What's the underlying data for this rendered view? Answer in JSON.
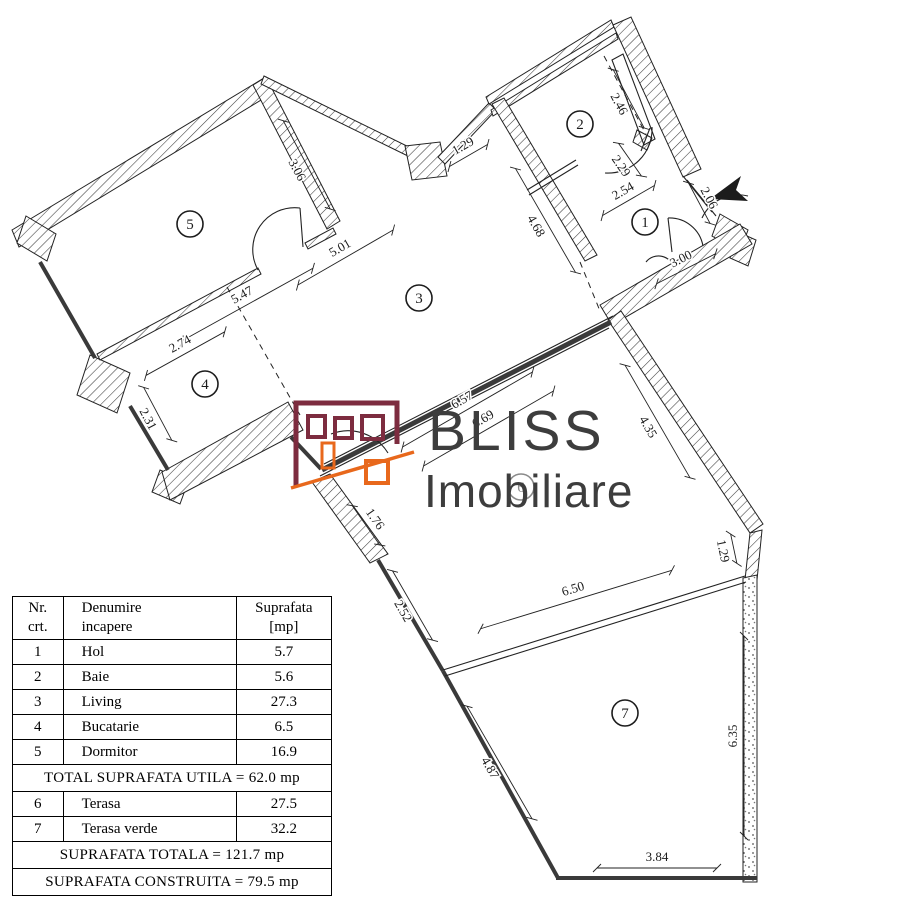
{
  "logo": {
    "line1": "BLISS",
    "line2": "Imobiliare",
    "house_color": "#7d2c3f",
    "accent_color": "#e8681c",
    "text_color": "#3d3d3d"
  },
  "plan": {
    "rooms": [
      {
        "n": "1",
        "x": 645,
        "y": 222
      },
      {
        "n": "2",
        "x": 580,
        "y": 124
      },
      {
        "n": "3",
        "x": 419,
        "y": 298
      },
      {
        "n": "4",
        "x": 205,
        "y": 384
      },
      {
        "n": "5",
        "x": 190,
        "y": 224
      },
      {
        "n": "6",
        "x": 521,
        "y": 487,
        "ghost": true
      },
      {
        "n": "7",
        "x": 625,
        "y": 713
      }
    ],
    "dims": [
      {
        "v": "3.06",
        "x": 297,
        "y": 170,
        "r": 62,
        "len": 100,
        "s": -1
      },
      {
        "v": "1.29",
        "x": 463,
        "y": 146,
        "r": -30,
        "len": 44,
        "s": 1
      },
      {
        "v": "2.46",
        "x": 619,
        "y": 104,
        "r": 62,
        "len": 66,
        "s": -1
      },
      {
        "v": "2.29",
        "x": 621,
        "y": 166,
        "r": 55,
        "len": 40,
        "s": -1
      },
      {
        "v": "2.54",
        "x": 623,
        "y": 191,
        "r": -30,
        "len": 60,
        "s": 1
      },
      {
        "v": "2.06",
        "x": 709,
        "y": 198,
        "r": 62,
        "len": 46,
        "s": 1
      },
      {
        "v": "4.68",
        "x": 536,
        "y": 226,
        "r": 60,
        "len": 120,
        "s": -1
      },
      {
        "v": "3.00",
        "x": 681,
        "y": 259,
        "r": -27,
        "len": 66,
        "s": 1
      },
      {
        "v": "5.01",
        "x": 340,
        "y": 248,
        "r": -30,
        "len": 110,
        "s": 1
      },
      {
        "v": "5.47",
        "x": 242,
        "y": 295,
        "r": -29,
        "len": 150,
        "s": 1
      },
      {
        "v": "2.74",
        "x": 180,
        "y": 344,
        "r": -29,
        "len": 90,
        "s": 1
      },
      {
        "v": "2.31",
        "x": 148,
        "y": 419,
        "r": 62,
        "len": 60,
        "s": -1
      },
      {
        "v": "6.57",
        "x": 462,
        "y": 400,
        "r": -30,
        "len": 150,
        "s": 1
      },
      {
        "v": "6.69",
        "x": 483,
        "y": 419,
        "r": -30,
        "len": 150,
        "s": 1
      },
      {
        "v": "1.76",
        "x": 375,
        "y": 519,
        "r": 55,
        "len": 48,
        "s": 1
      },
      {
        "v": "4.35",
        "x": 648,
        "y": 427,
        "r": 60,
        "len": 130,
        "s": -1
      },
      {
        "v": "1.29",
        "x": 723,
        "y": 551,
        "r": 78,
        "len": 30,
        "s": -1
      },
      {
        "v": "2.52",
        "x": 403,
        "y": 611,
        "r": 60,
        "len": 80,
        "s": -1
      },
      {
        "v": "6.50",
        "x": 573,
        "y": 589,
        "r": -17,
        "len": 200,
        "s": 1
      },
      {
        "v": "6.35",
        "x": 733,
        "y": 736,
        "r": -90,
        "len": 200,
        "s": 1
      },
      {
        "v": "4.87",
        "x": 490,
        "y": 768,
        "r": 60,
        "len": 130,
        "s": -1
      },
      {
        "v": "3.84",
        "x": 657,
        "y": 857,
        "r": 0,
        "len": 120,
        "s": 1
      }
    ]
  },
  "table": {
    "headers": [
      "Nr.\ncrt.",
      "Denumire\nincapere",
      "Suprafata\n[mp]"
    ],
    "rows": [
      {
        "nr": "1",
        "name": "Hol",
        "area": "5.7"
      },
      {
        "nr": "2",
        "name": "Baie",
        "area": "5.6"
      },
      {
        "nr": "3",
        "name": "Living",
        "area": "27.3"
      },
      {
        "nr": "4",
        "name": "Bucatarie",
        "area": "6.5"
      },
      {
        "nr": "5",
        "name": "Dormitor",
        "area": "16.9"
      }
    ],
    "subtotal": "TOTAL SUPRAFATA UTILA = 62.0 mp",
    "rows2": [
      {
        "nr": "6",
        "name": "Terasa",
        "area": "27.5"
      },
      {
        "nr": "7",
        "name": "Terasa verde",
        "area": "32.2"
      }
    ],
    "total": "SUPRAFATA TOTALA = 121.7 mp",
    "built": "SUPRAFATA CONSTRUITA = 79.5 mp"
  }
}
